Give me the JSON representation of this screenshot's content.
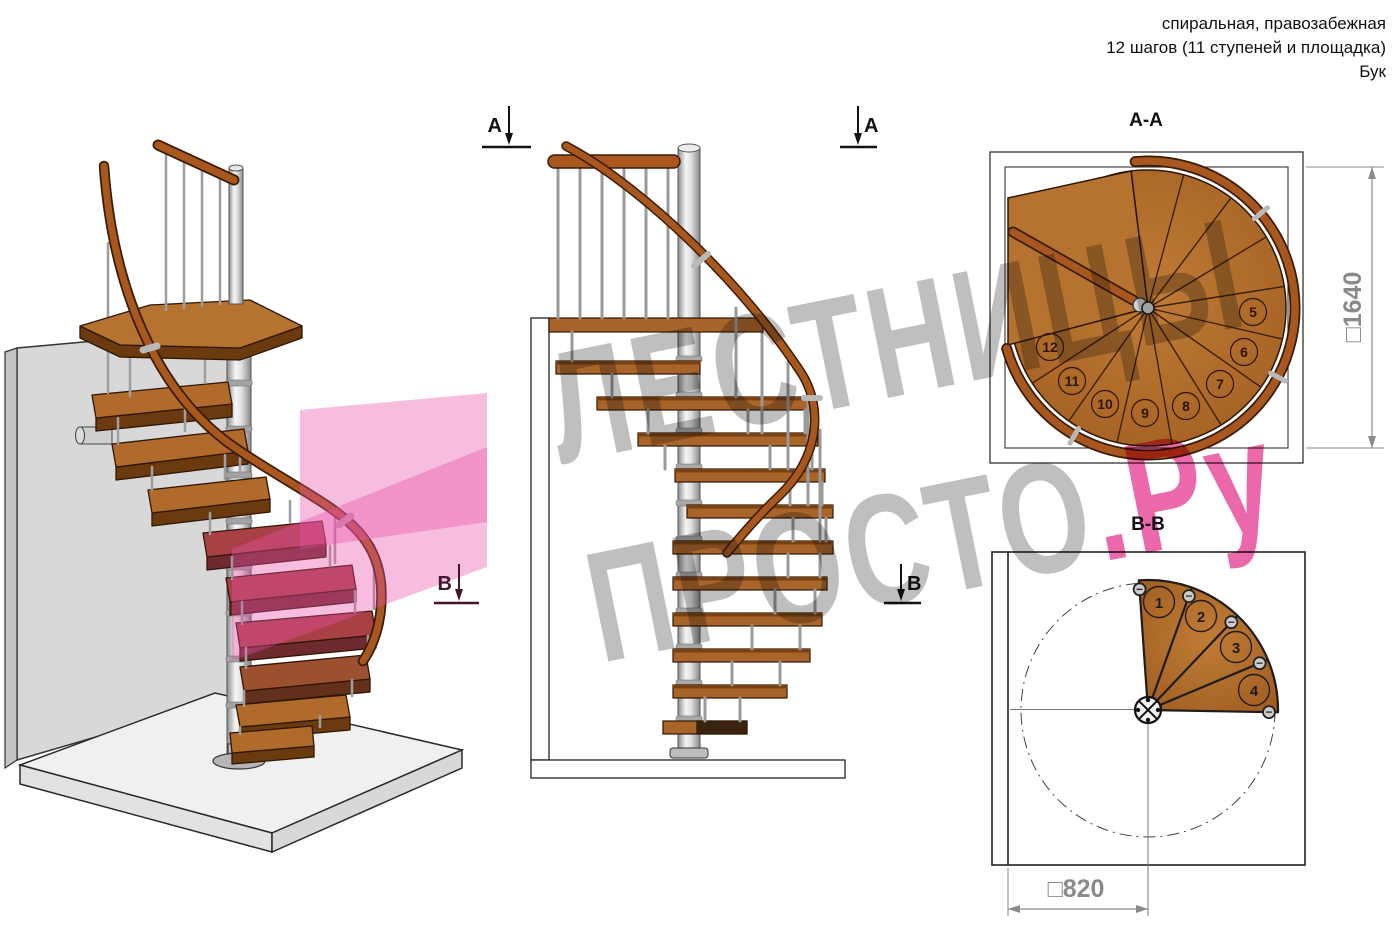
{
  "header": {
    "lines": [
      "спиральная, правозабежная",
      "12 шагов (11 ступеней и площадка)",
      "Бук"
    ]
  },
  "watermark": {
    "line1": "ЛЕСТНИЦЫ",
    "line2_gray": "ПРОСТО",
    "line2_pink": ".Ру"
  },
  "markers": {
    "a": "А",
    "b": "В"
  },
  "sections": {
    "aa": {
      "title": "А-А",
      "dim": "□1640",
      "step_numbers": [
        "5",
        "6",
        "7",
        "8",
        "9",
        "10",
        "11",
        "12"
      ]
    },
    "bb": {
      "title": "В-В",
      "dim": "□820",
      "step_numbers": [
        "1",
        "2",
        "3",
        "4"
      ]
    }
  },
  "colors": {
    "wood": "#b06a2b",
    "wood_dark": "#6b3a0f",
    "metal": "#c9c9c9",
    "red_step": "#a84046",
    "pink_overlay": "#e951a8",
    "watermark_gray": "#b4b4b4",
    "watermark_pink": "#e84f9c",
    "dim_gray": "#8a8a8a"
  }
}
